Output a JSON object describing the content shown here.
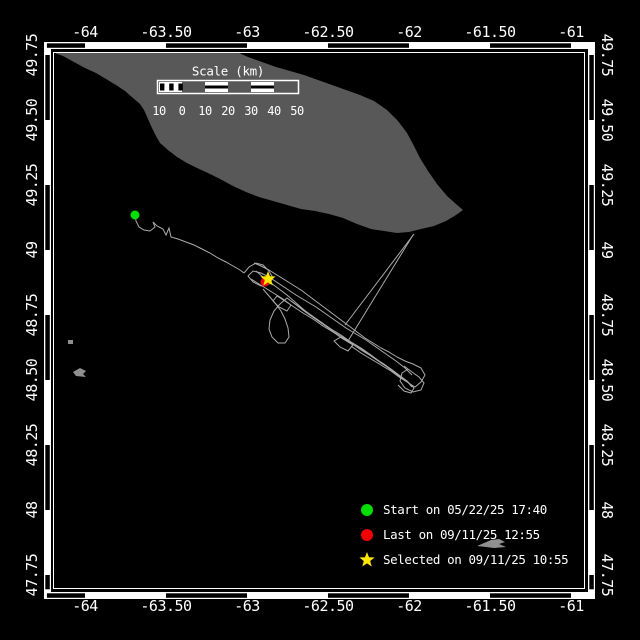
{
  "colors": {
    "background": "#000000",
    "frame": "#ffffff",
    "text": "#ffffff",
    "island": "#585858",
    "track": "#ababab",
    "start_marker": "#00dd00",
    "last_marker": "#f40000",
    "selected_marker": "#ffe800",
    "fragments": "#8f8f8f",
    "cursor": "#909090"
  },
  "axes": {
    "lon_ticks": [
      {
        "value": -64,
        "label": "-64"
      },
      {
        "value": -63.5,
        "label": "-63.50"
      },
      {
        "value": -63,
        "label": "-63"
      },
      {
        "value": -62.5,
        "label": "-62.50"
      },
      {
        "value": -62,
        "label": "-62"
      },
      {
        "value": -61.5,
        "label": "-61.50"
      },
      {
        "value": -61,
        "label": "-61"
      }
    ],
    "lat_ticks": [
      {
        "value": 49.75,
        "label": "49.75"
      },
      {
        "value": 49.5,
        "label": "49.50"
      },
      {
        "value": 49.25,
        "label": "49.25"
      },
      {
        "value": 49,
        "label": "49"
      },
      {
        "value": 48.75,
        "label": "48.75"
      },
      {
        "value": 48.5,
        "label": "48.50"
      },
      {
        "value": 48.25,
        "label": "48.25"
      },
      {
        "value": 48,
        "label": "48"
      },
      {
        "value": 47.75,
        "label": "47.75"
      }
    ]
  },
  "scale_bar": {
    "title": "Scale (km)",
    "tick_labels": [
      "10",
      "0",
      "10",
      "20",
      "30",
      "40",
      "50"
    ]
  },
  "legend": {
    "entries": [
      {
        "marker": "start-dot",
        "label": "Start on 05/22/25 17:40"
      },
      {
        "marker": "last-dot",
        "label": "Last on 09/11/25 12:55"
      },
      {
        "marker": "selected-star",
        "label": "Selected on 09/11/25 10:55"
      }
    ]
  }
}
